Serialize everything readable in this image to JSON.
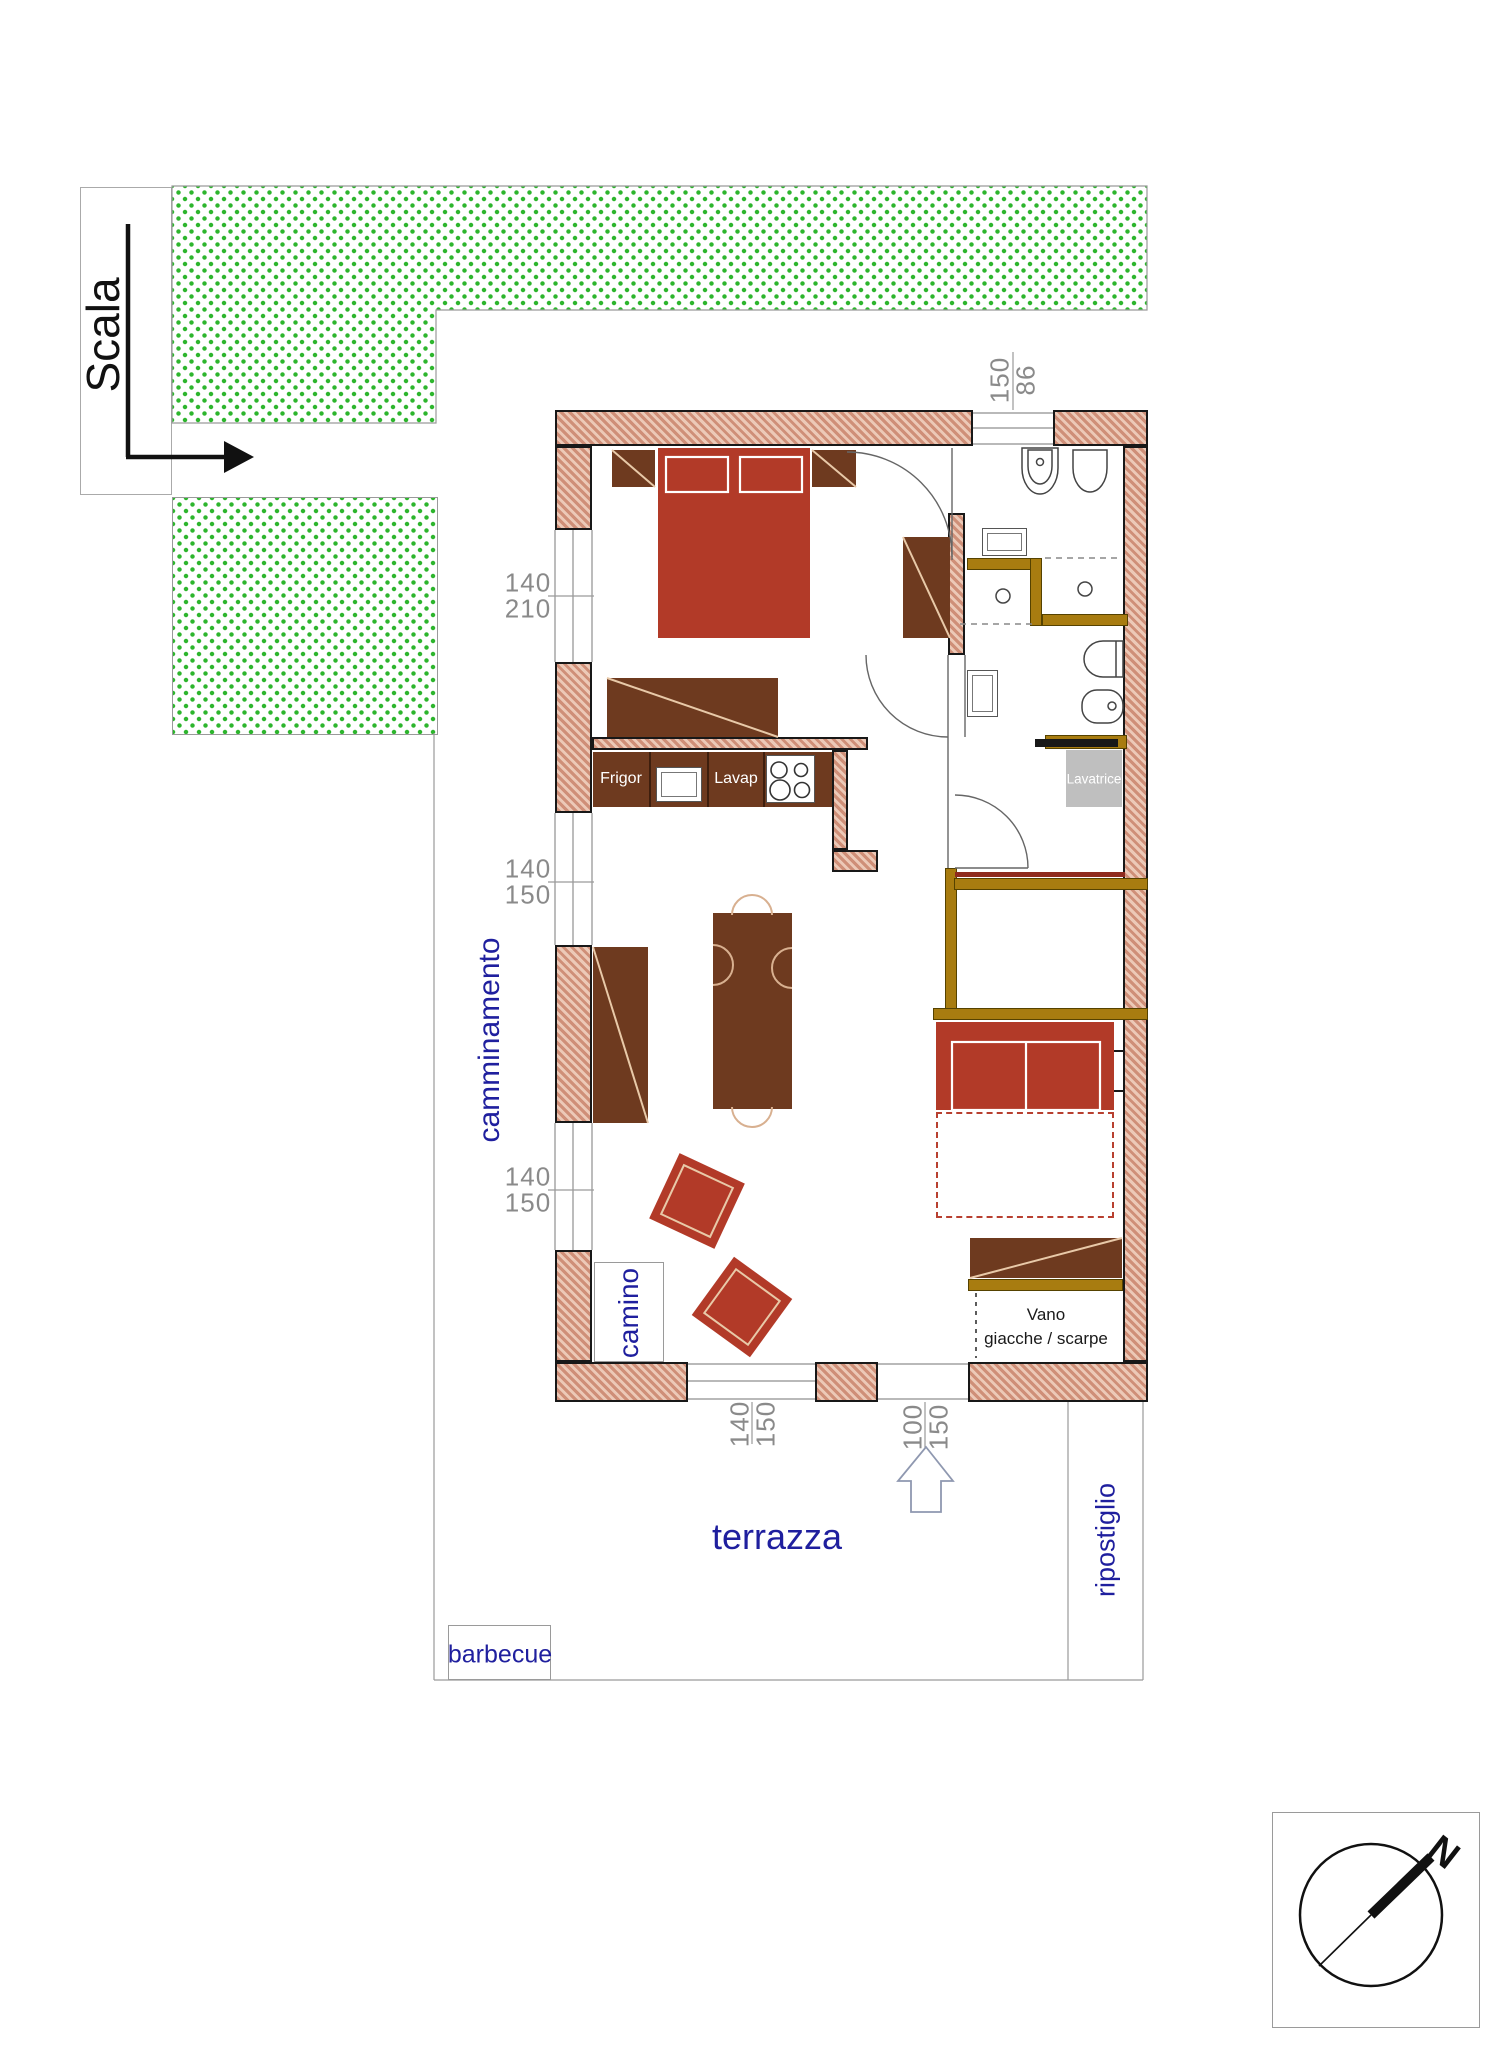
{
  "plan": {
    "labels": {
      "scala": "Scala",
      "camminamento": "camminamento",
      "camino": "camino",
      "terrazza": "terrazza",
      "ripostiglio": "ripostiglio",
      "barbecue": "barbecue",
      "frigor": "Frigor",
      "lavap": "Lavap",
      "lavatrice": "Lavatrice",
      "vano_line1": "Vano",
      "vano_line2": "giacche / scarpe",
      "north": "N"
    },
    "dimensions": {
      "bedroom_window": [
        "140",
        "210"
      ],
      "living_window_upper": [
        "140",
        "150"
      ],
      "living_window_lower": [
        "140",
        "150"
      ],
      "terrace_window": [
        "140",
        "150"
      ],
      "entry_door": [
        "100",
        "150"
      ],
      "bath_window": [
        "150",
        "86"
      ]
    },
    "colors": {
      "wall_fill": "#cf8f78",
      "wall_hatch": "#ecc9b7",
      "partition_olive": "#a87c10",
      "furniture_red": "#b23a28",
      "furniture_brown": "#6e3a1f",
      "landscape_green": "#2db52d",
      "label_blue": "#1f1f9e",
      "dimension_gray": "#8a8a8a"
    }
  }
}
